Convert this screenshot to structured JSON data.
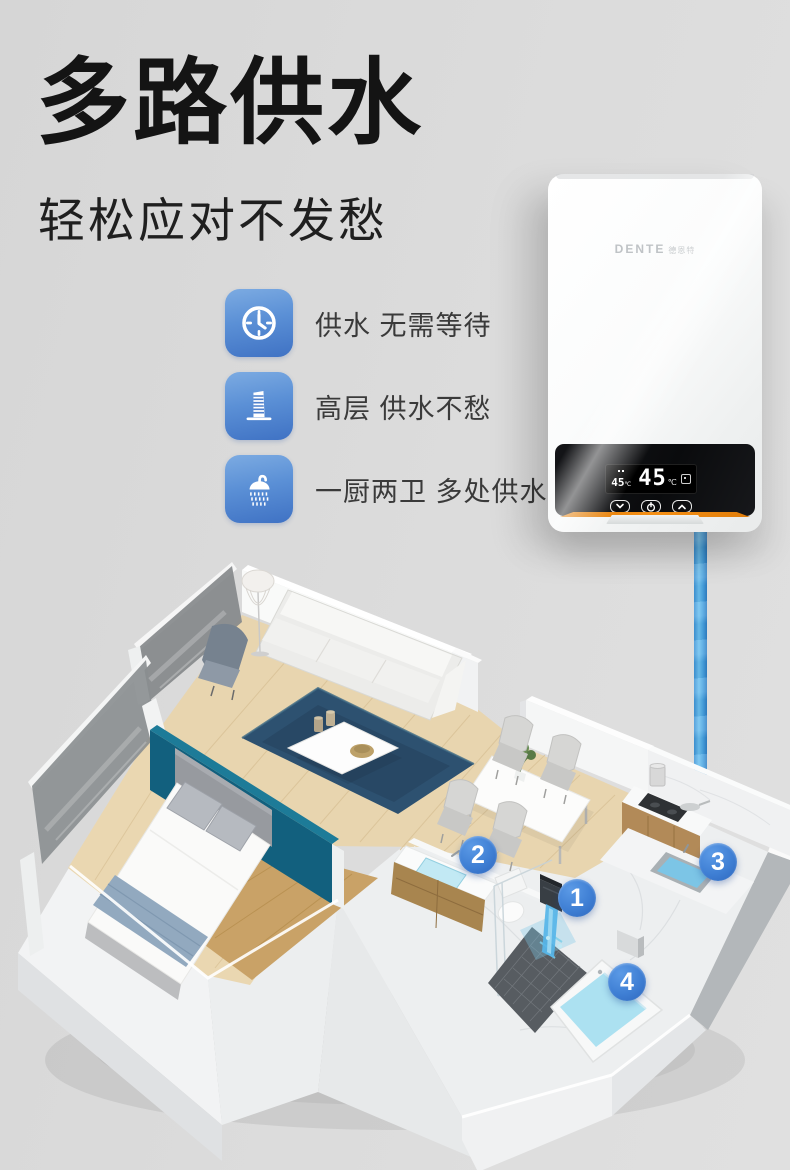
{
  "headline": {
    "title": "多路供水",
    "subtitle": "轻松应对不发愁"
  },
  "features": [
    {
      "icon": "clock-icon",
      "label": "供水 无需等待"
    },
    {
      "icon": "building-icon",
      "label": "高层 供水不愁"
    },
    {
      "icon": "shower-icon",
      "label": "一厨两卫 多处供水"
    }
  ],
  "heater": {
    "brand": "DENTE",
    "brand_cn": "德恩特",
    "display": {
      "set_temp": "45",
      "set_unit": "℃",
      "out_temp": "45",
      "out_unit": "℃"
    },
    "controls": [
      {
        "icon": "down-chevron-icon"
      },
      {
        "icon": "power-icon"
      },
      {
        "icon": "up-chevron-icon"
      }
    ]
  },
  "floorplan": {
    "markers": [
      {
        "number": "1",
        "location": "shower"
      },
      {
        "number": "2",
        "location": "bathroom-sink"
      },
      {
        "number": "3",
        "location": "kitchen-sink"
      },
      {
        "number": "4",
        "location": "bathtub"
      }
    ]
  },
  "colors": {
    "background": "#dcdcdc",
    "marker_blue": "#3f7fd4",
    "icon_blue_top": "#7cabe2",
    "icon_blue_bottom": "#3f72c4",
    "orange_accent": "#f08408",
    "pipe_blue": "#49a4e1",
    "teal_wall": "#12607e",
    "rug_blue": "#2d5170",
    "water_blue": "#ace1f1"
  }
}
